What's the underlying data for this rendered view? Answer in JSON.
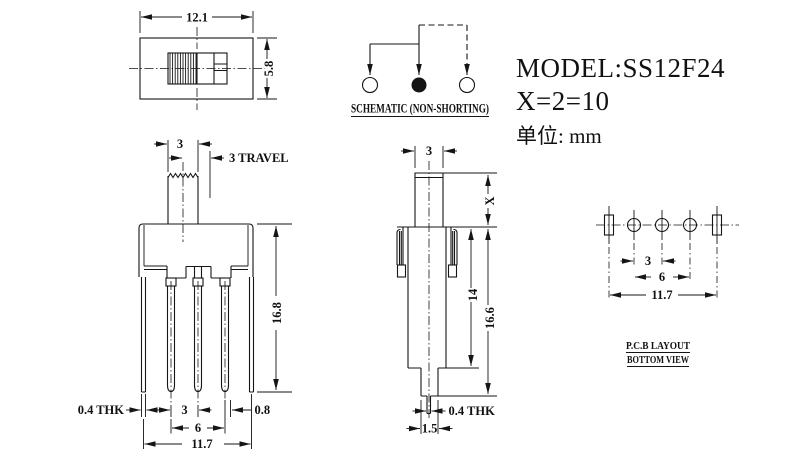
{
  "title_block": {
    "model": "MODEL:SS12F24",
    "x_spec": "X=2=10",
    "unit": "单位: mm"
  },
  "top_view": {
    "dim_width": "12.1",
    "dim_height": "5.8"
  },
  "schematic": {
    "caption": "SCHEMATIC (NON-SHORTING)"
  },
  "front_view": {
    "dim_knob_width": "3",
    "dim_travel": "3 TRAVEL",
    "dim_height": "16.8",
    "dim_pin_thickness": "0.4 THK",
    "dim_pitch": "3",
    "dim_edge": "0.8",
    "dim_span": "6",
    "dim_total": "11.7"
  },
  "side_view": {
    "dim_knob_width": "3",
    "dim_x": "X",
    "dim_body": "14",
    "dim_height": "16.6",
    "dim_pin_thickness": "0.4 THK",
    "dim_tip": "1.5"
  },
  "pcb_view": {
    "dim_pitch": "3",
    "dim_span": "6",
    "dim_total": "11.7",
    "caption_line1": "P.C.B LAYOUT",
    "caption_line2": "BOTTOM VIEW"
  }
}
